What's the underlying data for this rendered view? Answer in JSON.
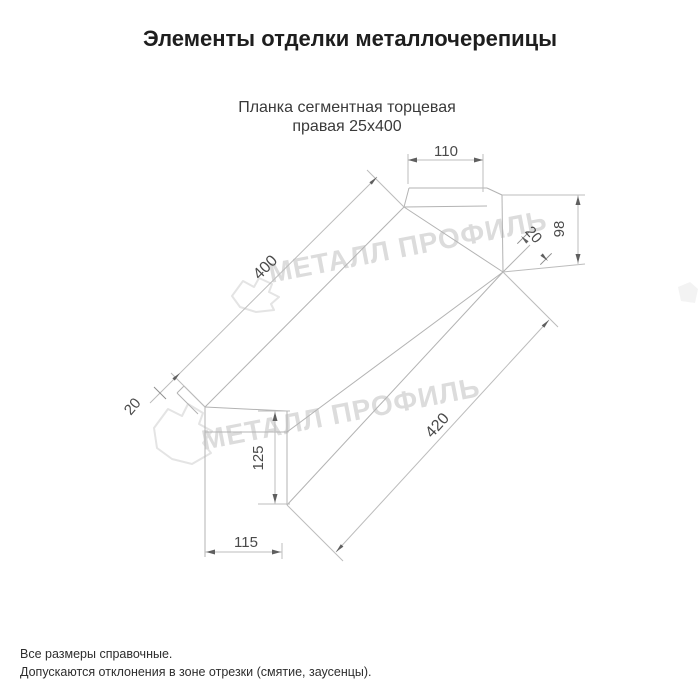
{
  "header": {
    "title": "Элементы отделки металлочерепицы"
  },
  "drawing": {
    "subtitle_line1": "Планка сегментная торцевая",
    "subtitle_line2": "правая 25х400",
    "dimensions": {
      "top_flange_width": "110",
      "end_height": "98",
      "end_fold": "20",
      "top_edge_length": "400",
      "near_fold": "20",
      "bottom_edge_length": "420",
      "front_height": "125",
      "bottom_flange_width": "115"
    },
    "watermark_text": "МЕТАЛЛ ПРОФИЛЬ",
    "watermark_logo": "metall-profil-cloud-logo",
    "colors": {
      "line": "#b3b3b3",
      "dimension_text": "#4a4a4a",
      "arrow": "#5f5f5f",
      "watermark": "#dcdcdc",
      "title_text": "#1e1e1e"
    }
  },
  "footer": {
    "note1": "Все размеры справочные.",
    "note2": "Допускаются отклонения в зоне отрезки (смятие, заусенцы)."
  }
}
